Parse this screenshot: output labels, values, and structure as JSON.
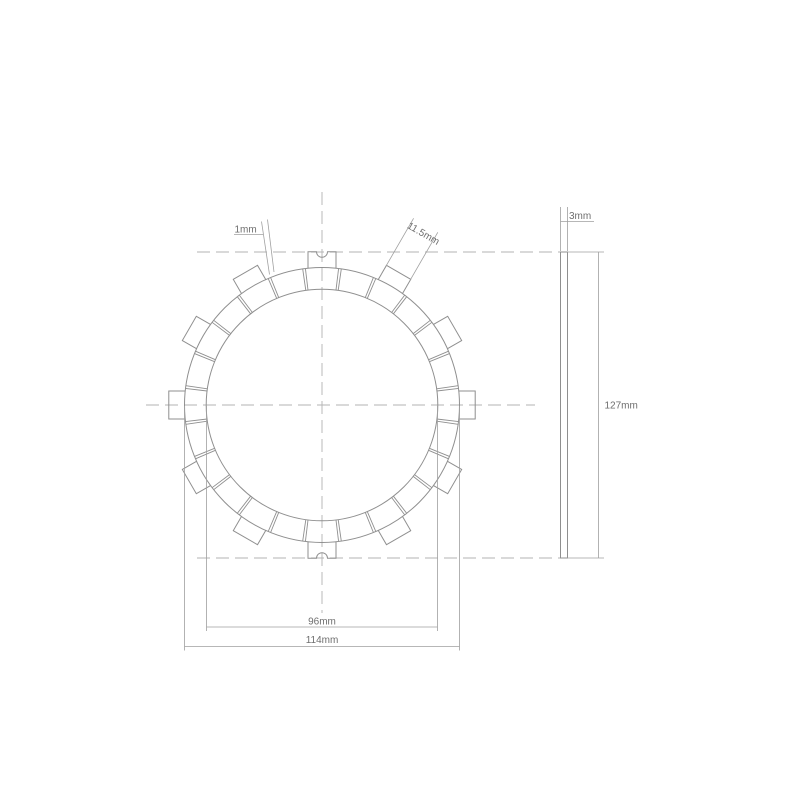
{
  "drawing": {
    "labels": {
      "pad_gap": "1mm",
      "lug_width": "11.5mm",
      "thickness": "3mm",
      "overall_diameter": "127mm",
      "inner_diameter": "96mm",
      "friction_diameter": "114mm"
    },
    "colors": {
      "background": "#ffffff",
      "line": "#8f8f8f",
      "dashed": "#b3b3b3",
      "dimension": "#a0a0a0",
      "text": "#6e6e6e"
    },
    "geometry": {
      "pad_count": 24,
      "lug_count": 12,
      "notched_lug_angles": [
        0,
        180
      ]
    }
  }
}
